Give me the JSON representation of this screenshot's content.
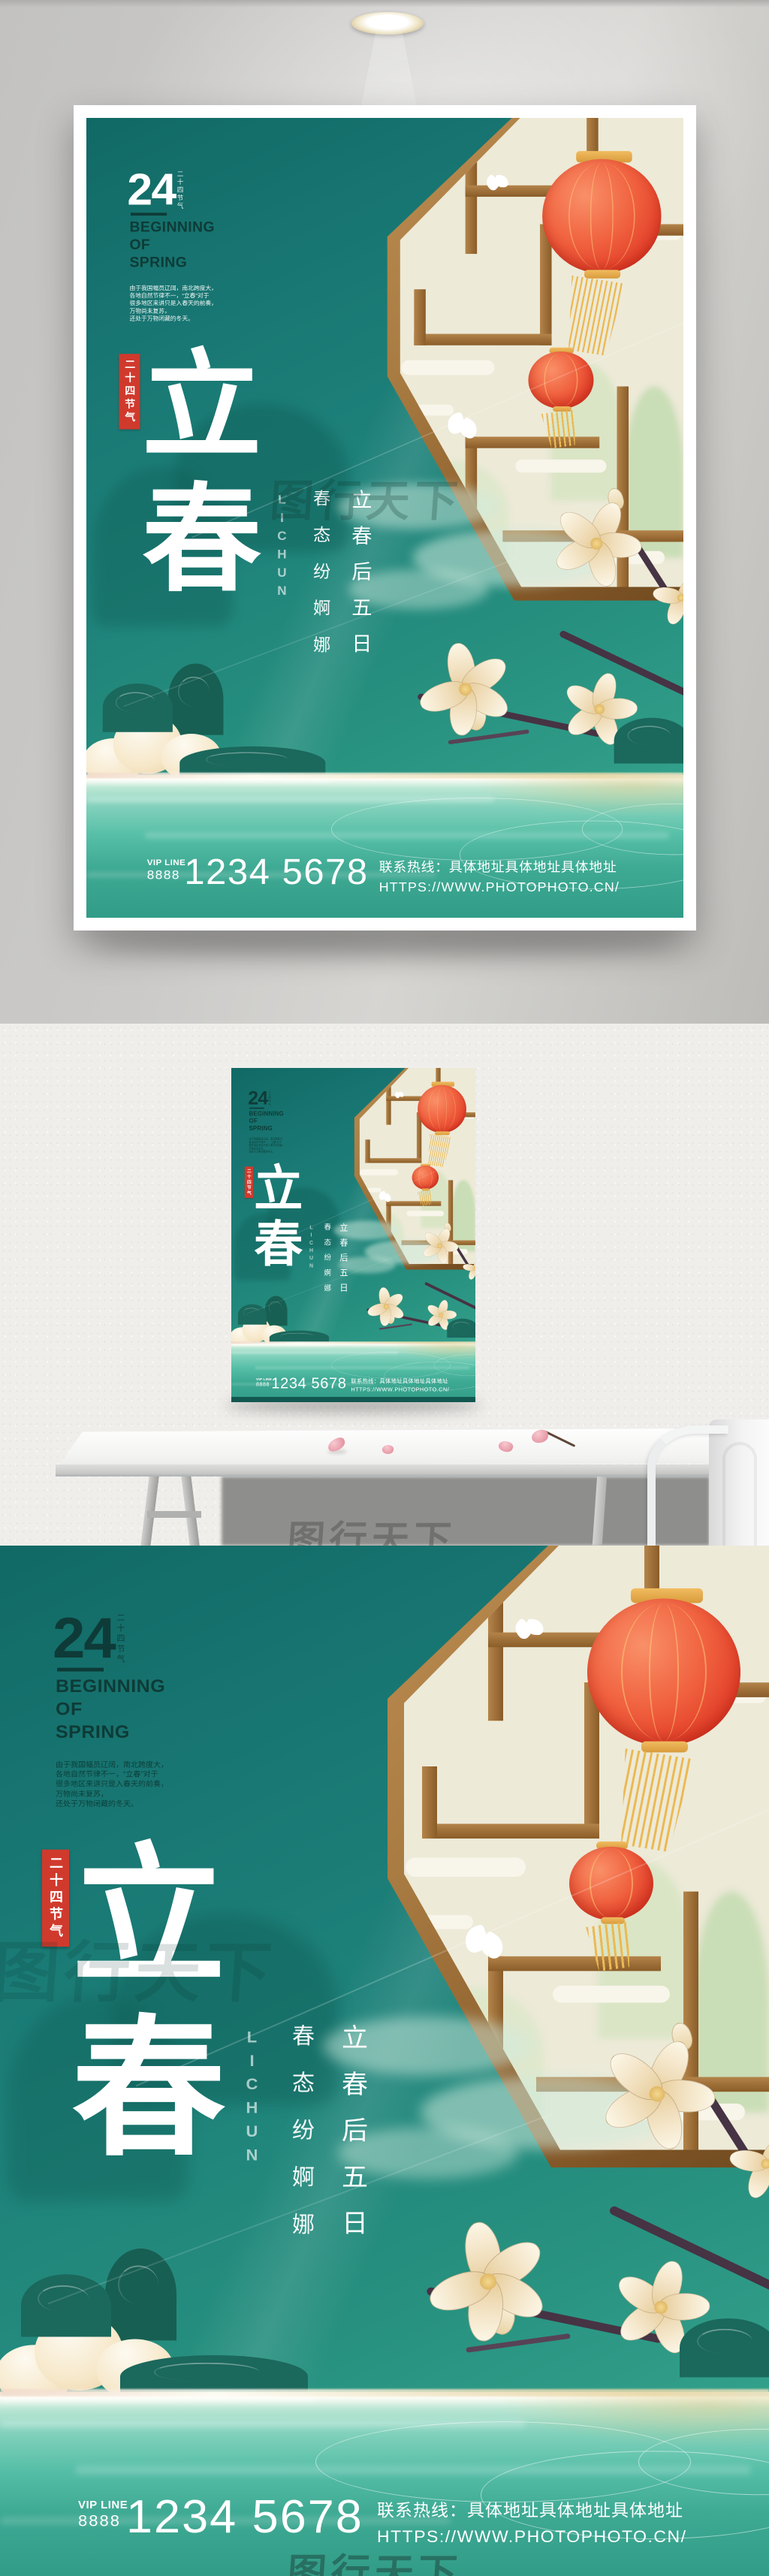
{
  "watermark": "图行天下",
  "poster": {
    "num": "24",
    "num_side": "二十四节气",
    "title_en": "BEGINNING\nOF\nSPRING",
    "desc": "由于我国幅员辽阔，南北跨度大，\n各地自然节律不一，“立春”对于\n很多地区来讲只是入春天的前奏，\n万物尚未复苏，\n还处于万物闭藏的冬天。",
    "badge": "二十四节气",
    "char1": "立",
    "char2": "春",
    "lichun": "LICHUN",
    "col_a": "春态纷婀娜",
    "col_b": "立春后五日",
    "vip_label": "VIP LINE",
    "vip_num": "8888",
    "phone": "1234 5678",
    "hotline": "联系热线：具体地址具体地址具体地址",
    "url": "HTTPS://WWW.PHOTOPHOTO.CN/"
  },
  "colors": {
    "teal_bg": "#1e827a",
    "badge_red": "#d03a2d",
    "lantern_red": "#ee4f35",
    "gold": "#e7ac4e",
    "window_cream": "#edead8",
    "wood_brown": "#a87b42",
    "dark_text": "#0e3b37",
    "water_aqua": "#57bfa7"
  }
}
